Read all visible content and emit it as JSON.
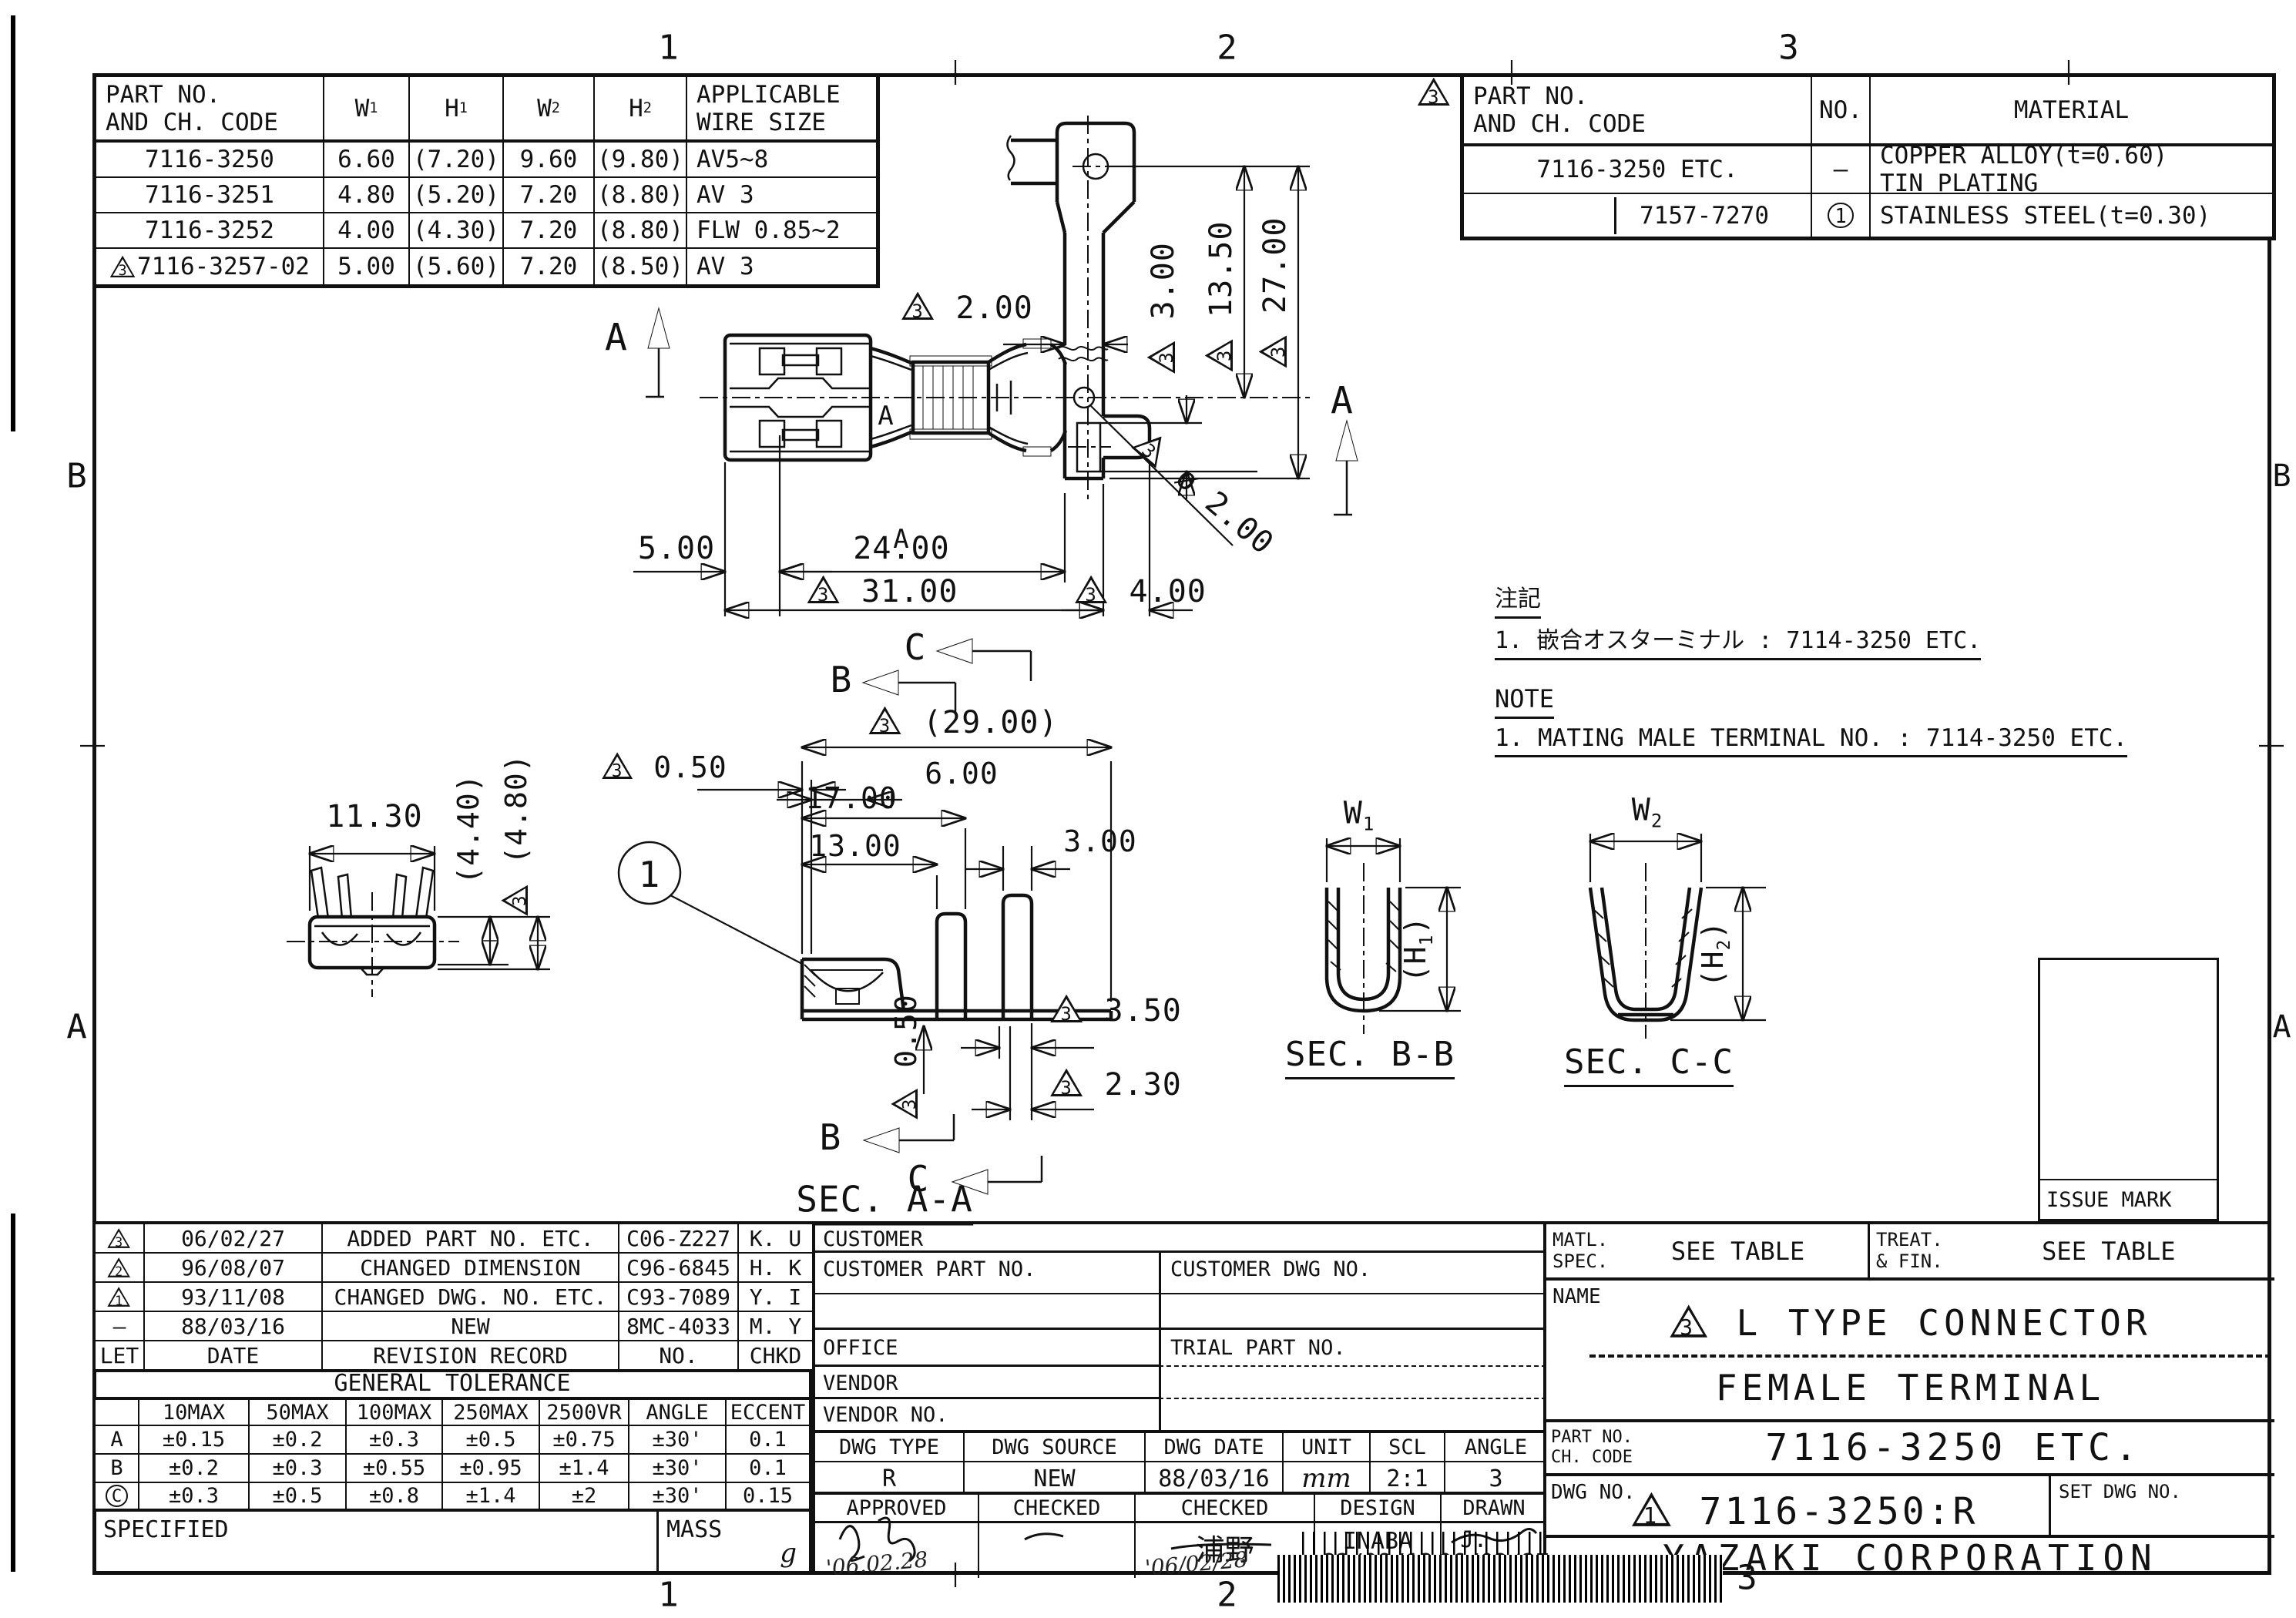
{
  "zones": {
    "top": [
      "1",
      "2",
      "3"
    ],
    "bottom": [
      "1",
      "2",
      "3"
    ],
    "left": [
      "B",
      "A"
    ],
    "right": [
      "B",
      "A"
    ]
  },
  "spec_table": {
    "h_part1": "PART NO.",
    "h_part2": "AND CH. CODE",
    "h_w1": "W₁",
    "h_h1": "H₁",
    "h_w2": "W₂",
    "h_h2": "H₂",
    "h_app1": "APPLICABLE",
    "h_app2": "WIRE SIZE",
    "rows": [
      [
        "7116-3250",
        "6.60",
        "(7.20)",
        "9.60",
        "(9.80)",
        "AV5~8"
      ],
      [
        "7116-3251",
        "4.80",
        "(5.20)",
        "7.20",
        "(8.80)",
        "AV 3"
      ],
      [
        "7116-3252",
        "4.00",
        "(4.30)",
        "7.20",
        "(8.80)",
        "FLW 0.85~2"
      ],
      [
        "△3 7116-3257-02",
        "5.00",
        "(5.60)",
        "7.20",
        "(8.50)",
        "AV 3"
      ]
    ]
  },
  "material_table": {
    "rev_mark": "△3",
    "h_part1": "PART NO.",
    "h_part2": "AND CH. CODE",
    "h_no": "NO.",
    "h_mat": "MATERIAL",
    "r1_part": "7116-3250 ETC.",
    "r1_no": "—",
    "r1_mat1": "COPPER ALLOY(t=0.60)",
    "r1_mat2": "TIN PLATING",
    "r2_part": "7157-7270",
    "r2_no": "(1)",
    "r2_mat": "STAINLESS STEEL(t=0.30)"
  },
  "notes": {
    "jp_title": "注記",
    "jp_1": "1. 嵌合オスターミナル : 7114-3250 ETC.",
    "en_title": "NOTE",
    "en_1": "1. MATING MALE TERMINAL NO. : 7114-3250 ETC."
  },
  "views": {
    "secaa": "SEC. A-A",
    "secbb": "SEC. B-B",
    "seccc": "SEC. C-C",
    "issue": "ISSUE MARK",
    "balloon": "1",
    "a": "A",
    "b": "B",
    "c": "C"
  },
  "dims": {
    "plan": {
      "w_strip": "△3 2.00",
      "v3": "△3 3.00",
      "v13_5": "△3 13.50",
      "v27": "△3 27.00",
      "hole": "△3 ø 2.00",
      "d5": "5.00",
      "d24": "24.00",
      "d31": "△3 31.00",
      "d4": "△3 4.00"
    },
    "secaa": {
      "d29": "△3 (29.00)",
      "d05a": "△3 0.50",
      "d6": "6.00",
      "d17": "17.00",
      "d13": "13.00",
      "d3": "3.00",
      "d05b": "△3 0.50",
      "d35": "△3 3.50",
      "d23": "△3 2.30"
    },
    "front": {
      "d113": "11.30",
      "d44": "(4.40)",
      "d48": "△3 (4.80)"
    },
    "secbb": {
      "w": "W₁",
      "h": "(H₁)"
    },
    "seccc": {
      "w": "W₂",
      "h": "(H₂)"
    }
  },
  "revision": {
    "rows": [
      [
        "△3",
        "06/02/27",
        "ADDED PART NO. ETC.",
        "C06-Z227",
        "K. U"
      ],
      [
        "△2",
        "96/08/07",
        "CHANGED DIMENSION",
        "C96-6845",
        "H. K"
      ],
      [
        "△1",
        "93/11/08",
        "CHANGED DWG. NO. ETC.",
        "C93-7089",
        "Y. I"
      ],
      [
        "–",
        "88/03/16",
        "NEW",
        "8MC-4033",
        "M. Y"
      ],
      [
        "LET",
        "DATE",
        "REVISION RECORD",
        "NO.",
        "CHKD"
      ]
    ]
  },
  "tolerance": {
    "title": "GENERAL TOLERANCE",
    "headers": [
      "",
      "10MAX",
      "50MAX",
      "100MAX",
      "250MAX",
      "2500VR",
      "ANGLE",
      "ECCENT"
    ],
    "rows": [
      [
        "A",
        "±0.15",
        "±0.2",
        "±0.3",
        "±0.5",
        "±0.75",
        "±30'",
        "0.1"
      ],
      [
        "B",
        "±0.2",
        "±0.3",
        "±0.55",
        "±0.95",
        "±1.4",
        "±30'",
        "0.1"
      ],
      [
        "(C)",
        "±0.3",
        "±0.5",
        "±0.8",
        "±1.4",
        "±2",
        "±30'",
        "0.15"
      ]
    ],
    "specified": "SPECIFIED",
    "mass": "MASS",
    "mass_unit": "g"
  },
  "customer": {
    "customer": "CUSTOMER",
    "part": "CUSTOMER PART NO.",
    "dwg": "CUSTOMER DWG NO.",
    "office": "OFFICE",
    "trial": "TRIAL PART NO.",
    "vendor": "VENDOR",
    "vendor_no": "VENDOR NO."
  },
  "dwg_row": {
    "headers": [
      "DWG TYPE",
      "DWG SOURCE",
      "DWG DATE",
      "UNIT",
      "SCL",
      "ANGLE"
    ],
    "values": [
      "R",
      "NEW",
      "88/03/16",
      "mm",
      "2:1",
      "3"
    ]
  },
  "approval": {
    "headers": [
      "APPROVED",
      "CHECKED",
      "CHECKED",
      "DESIGN",
      "DRAWN"
    ],
    "checked2_name": "浦野",
    "design_name": "INABA",
    "drawn_name": "J. PAULY",
    "approved_date": "'06.02.28",
    "checked2_date": "'06/02/28",
    "design_date": "82/08/13",
    "drawn_date": "06/02/27"
  },
  "title_block": {
    "matl1": "MATL.",
    "matl2": "SPEC.",
    "matl_val": "SEE TABLE",
    "treat1": "TREAT.",
    "treat2": "& FIN.",
    "treat_val": "SEE TABLE",
    "name_label": "NAME",
    "name1": "△3 L TYPE CONNECTOR",
    "name2": "FEMALE TERMINAL",
    "part_label1": "PART NO.",
    "part_label2": "CH. CODE",
    "part_val": "7116-3250 ETC.",
    "dwg_label": "DWG NO.",
    "dwg_val": "△1 7116-3250:R",
    "set_label": "SET DWG NO.",
    "company": "YAZAKI CORPORATION"
  }
}
